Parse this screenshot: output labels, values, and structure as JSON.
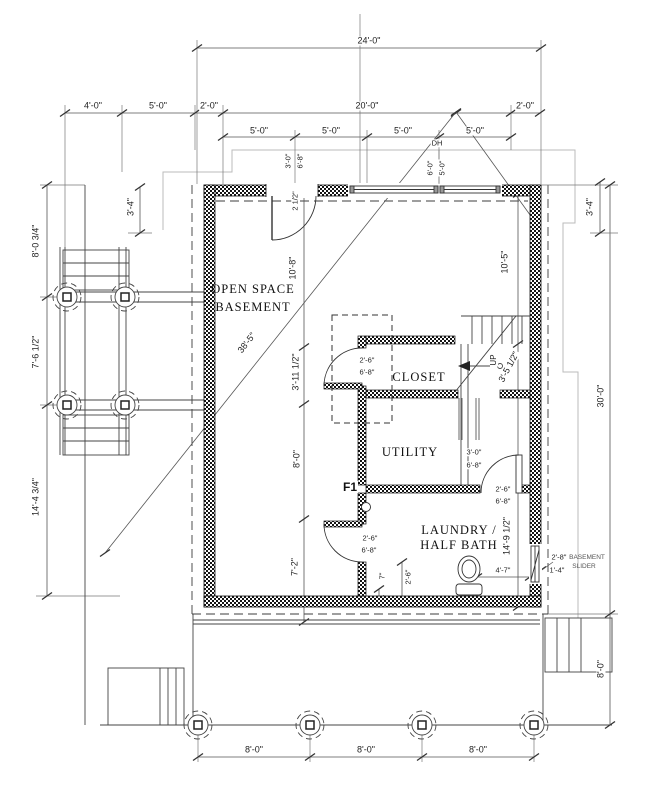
{
  "drawing": {
    "rooms": {
      "open_space_1": "OPEN SPACE",
      "open_space_2": "BASEMENT",
      "closet": "CLOSET",
      "utility": "UTILITY",
      "laundry_1": "LAUNDRY /",
      "laundry_2": "HALF BATH"
    },
    "marks": {
      "footing": "F1",
      "stair_direction": "UP",
      "window_type": "DH",
      "slider_1": "BASEMENT",
      "slider_2": "SLIDER"
    },
    "dims": {
      "overall_width": "24'-0\"",
      "offsets_top": [
        "4'-0\"",
        "5'-0\"",
        "2'-0\"",
        "20'-0\"",
        "2'-0\""
      ],
      "window_bay": "5'-0\"",
      "window_size": [
        "6'-0\"",
        "5'-0\""
      ],
      "entry_door": [
        "3'-0\"",
        "6'-8\""
      ],
      "jamb_offset": "2 1/2\"",
      "corner_left": "3'-4\"",
      "corner_right": "3'-4\"",
      "left_string": [
        "8'-0 3/4\"",
        "7'-6 1/2\"",
        "14'-4 3/4\""
      ],
      "interior_left": [
        "10'-8\"",
        "3'-11 1/2\"",
        "8'-0\"",
        "7'-2\""
      ],
      "interior_right": [
        "10'-5\"",
        "3'-5 1/2\"",
        "14'-9 1/2\""
      ],
      "overall_height": "30'-0\"",
      "right_stair_depth": "8'-0\"",
      "closet_door": [
        "2'-6\"",
        "6'-8\""
      ],
      "understair_door": [
        "3'-0\"",
        "6'-8\""
      ],
      "laundry_door": [
        "2'-6\"",
        "6'-8\""
      ],
      "open_space_door": [
        "2'-6\"",
        "6'-8\""
      ],
      "toilet_offset": "4'-7\"",
      "wall_stub": "7\"",
      "door_clear": "2'-6\"",
      "slider_width": "2'-8\"",
      "slider_half": "1'-4\"",
      "diagonal": "38'-5\"",
      "pier_bay": "8'-0\""
    },
    "colors": {
      "line": "#3c3c3c",
      "wall": "#111111",
      "site": "#bbbbbb"
    }
  }
}
